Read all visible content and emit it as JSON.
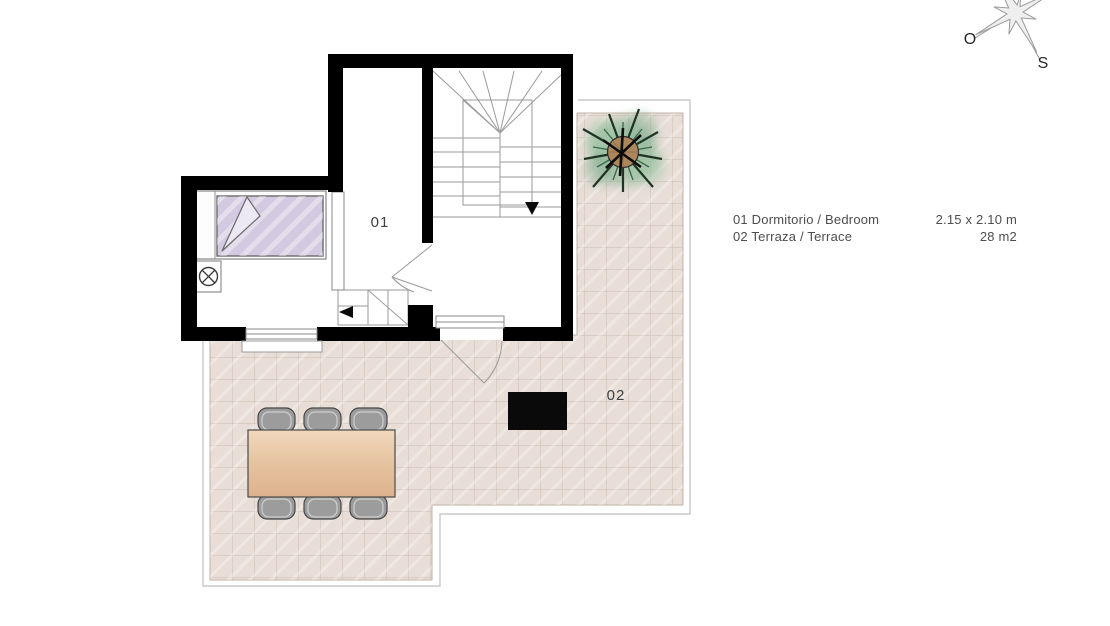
{
  "plan_title": "floor-plan",
  "rooms": {
    "bedroom": {
      "number": "01"
    },
    "terrace": {
      "number": "02"
    }
  },
  "legend": {
    "rows": [
      {
        "label": "01 Dormitorio / Bedroom",
        "value": "2.15 x 2.10 m"
      },
      {
        "label": "02 Terraza / Terrace",
        "value": "28 m2"
      }
    ]
  },
  "compass": {
    "west": "O",
    "south": "S"
  },
  "icons": [
    "compass-rose-icon",
    "bed-icon",
    "lamp-table-icon",
    "dining-table-icon",
    "chair-icon",
    "palm-plant-icon",
    "stairs-icon",
    "door-swing-icon",
    "direction-arrow-icon"
  ],
  "colors": {
    "wall": "#000000",
    "tile_floor": "#e8ded7",
    "tile_grid": "#cbbdb1",
    "slab_outline": "#c9c9c9",
    "bed_blanket": "#d3cae1",
    "bed_fold": "#ece8f4",
    "table_wood": "#e6c3a0",
    "chair": "#9c9c9c",
    "equipment_box": "#0a0a0a",
    "plant_canopy": "#7fb08c",
    "plant_foliage": "#1e3526",
    "plant_trunk": "#ad875c",
    "compass_star": "#efefef",
    "label_text": "#4a4a4a"
  }
}
